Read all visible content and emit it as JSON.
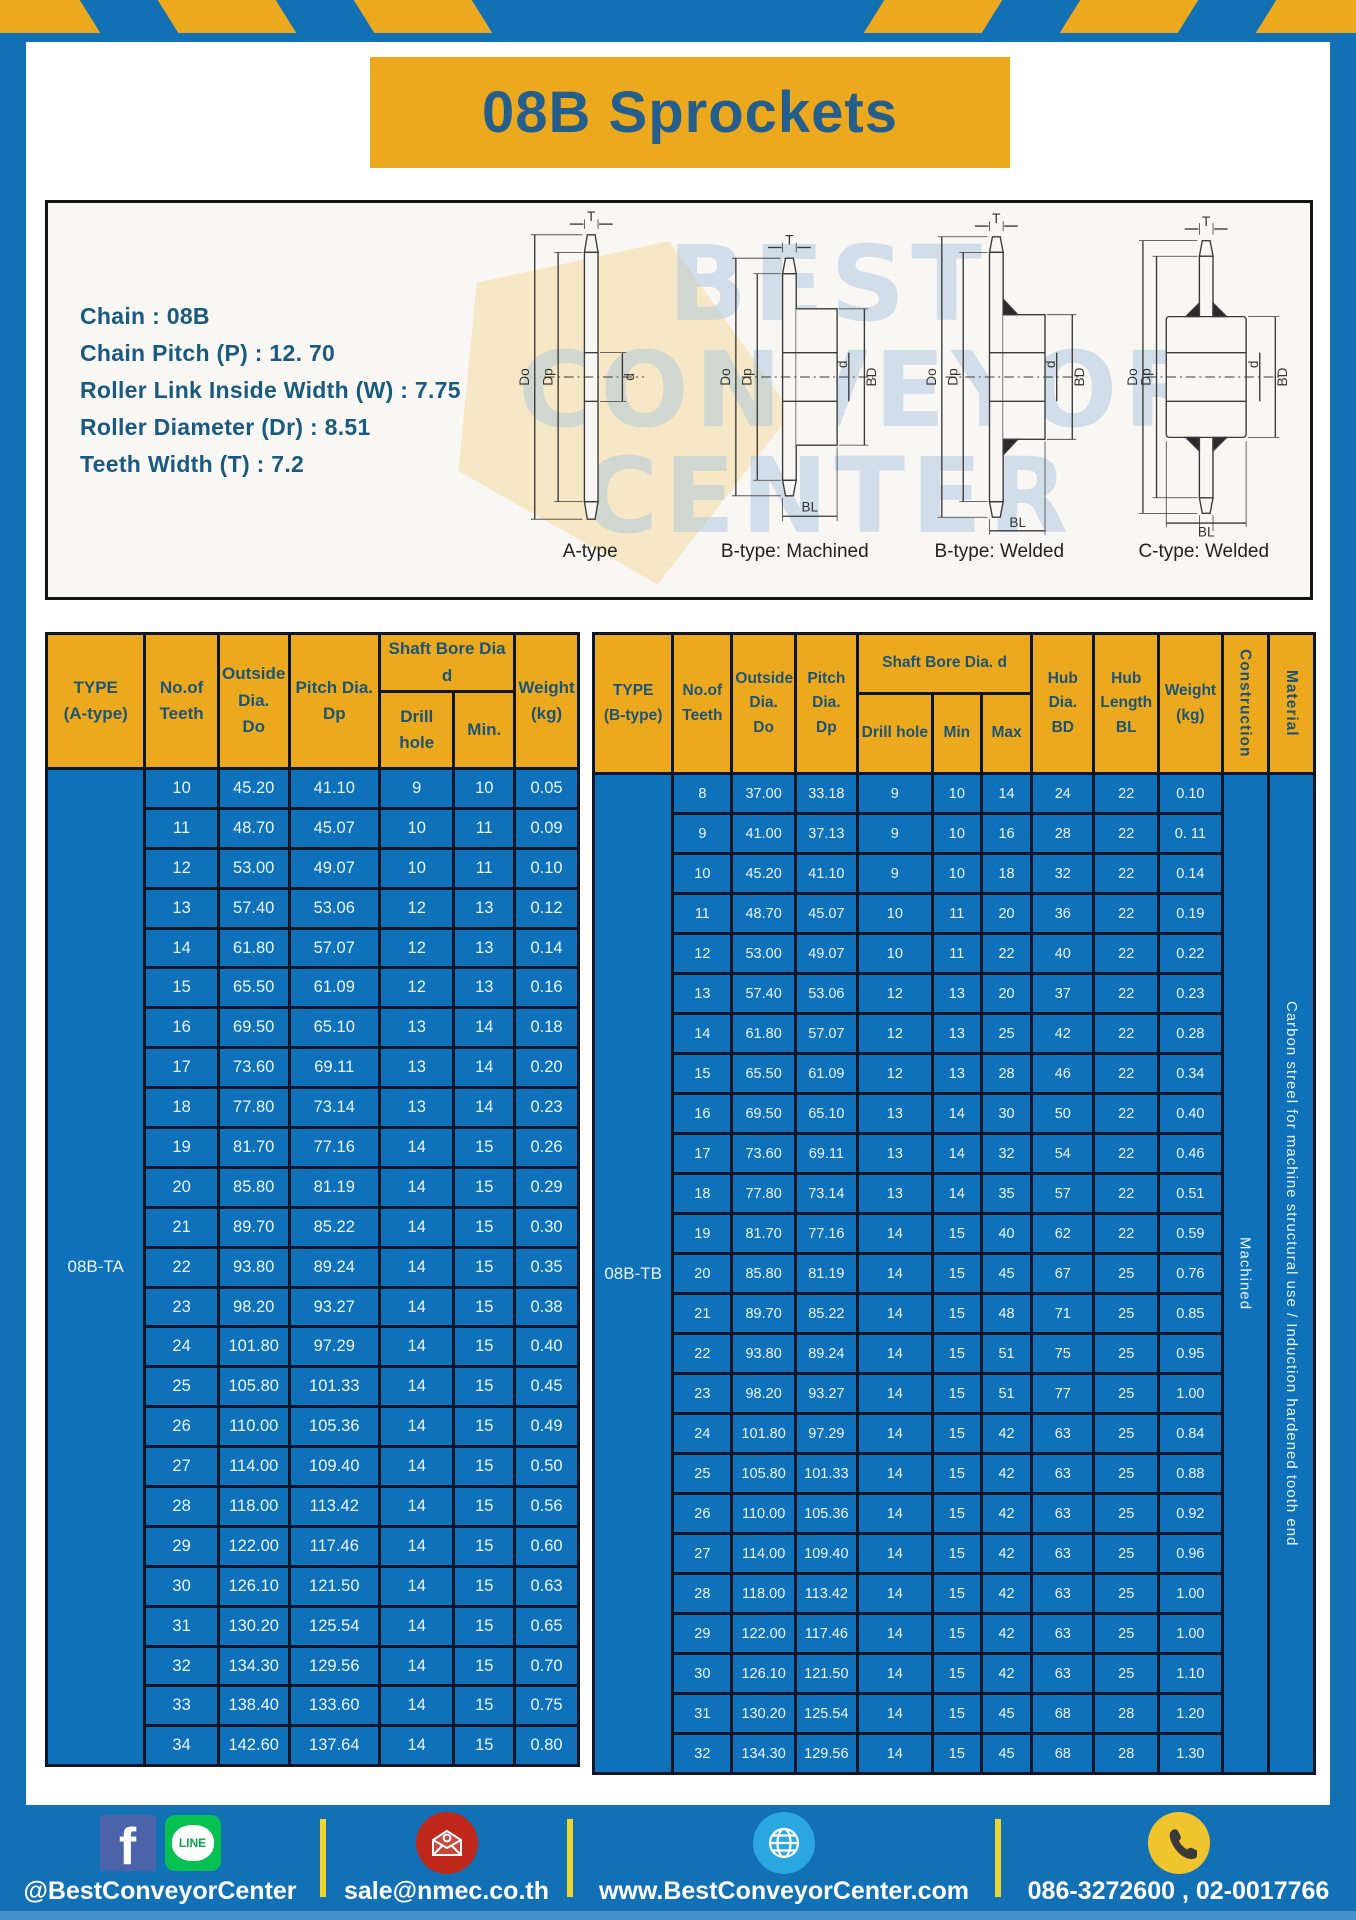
{
  "page": {
    "title": "08B Sprockets"
  },
  "specs": {
    "lines": [
      "Chain  : 08B",
      "Chain Pitch (P)  :  12. 70",
      "Roller Link Inside Width (W)  :  7.75",
      "Roller Diameter (Dr)  : 8.51",
      "Teeth Width (T)  :  7.2"
    ]
  },
  "watermark": {
    "line1": "BEST",
    "line2": "CONVEYOR",
    "line3": "CENTER"
  },
  "drawings": [
    {
      "label": "A-type",
      "dims": {
        "t": "T",
        "do": "Do",
        "dp": "Dp",
        "d": "d"
      }
    },
    {
      "label": "B-type: Machined",
      "dims": {
        "t": "T",
        "do": "Do",
        "dp": "Dp",
        "d": "d",
        "bd": "BD",
        "bl": "BL"
      }
    },
    {
      "label": "B-type: Welded",
      "dims": {
        "t": "T",
        "do": "Do",
        "dp": "Dp",
        "d": "d",
        "bd": "BD",
        "bl": "BL"
      }
    },
    {
      "label": "C-type: Welded",
      "dims": {
        "t": "T",
        "do": "Do",
        "dp": "Dp",
        "d": "d",
        "bd": "BD",
        "bl": "BL"
      }
    }
  ],
  "table_a": {
    "header": {
      "type": "TYPE\n(A-type)",
      "teeth": "No.of\nTeeth",
      "outside": "Outside\nDia.\nDo",
      "pitch": "Pitch Dia.\nDp",
      "shaft": "Shaft Bore Dia d",
      "drill": "Drill hole",
      "min": "Min.",
      "weight": "Weight\n(kg)"
    },
    "type_value": "08B-TA",
    "rows": [
      [
        "10",
        "45.20",
        "41.10",
        "9",
        "10",
        "0.05"
      ],
      [
        "11",
        "48.70",
        "45.07",
        "10",
        "11",
        "0.09"
      ],
      [
        "12",
        "53.00",
        "49.07",
        "10",
        "11",
        "0.10"
      ],
      [
        "13",
        "57.40",
        "53.06",
        "12",
        "13",
        "0.12"
      ],
      [
        "14",
        "61.80",
        "57.07",
        "12",
        "13",
        "0.14"
      ],
      [
        "15",
        "65.50",
        "61.09",
        "12",
        "13",
        "0.16"
      ],
      [
        "16",
        "69.50",
        "65.10",
        "13",
        "14",
        "0.18"
      ],
      [
        "17",
        "73.60",
        "69.11",
        "13",
        "14",
        "0.20"
      ],
      [
        "18",
        "77.80",
        "73.14",
        "13",
        "14",
        "0.23"
      ],
      [
        "19",
        "81.70",
        "77.16",
        "14",
        "15",
        "0.26"
      ],
      [
        "20",
        "85.80",
        "81.19",
        "14",
        "15",
        "0.29"
      ],
      [
        "21",
        "89.70",
        "85.22",
        "14",
        "15",
        "0.30"
      ],
      [
        "22",
        "93.80",
        "89.24",
        "14",
        "15",
        "0.35"
      ],
      [
        "23",
        "98.20",
        "93.27",
        "14",
        "15",
        "0.38"
      ],
      [
        "24",
        "101.80",
        "97.29",
        "14",
        "15",
        "0.40"
      ],
      [
        "25",
        "105.80",
        "101.33",
        "14",
        "15",
        "0.45"
      ],
      [
        "26",
        "110.00",
        "105.36",
        "14",
        "15",
        "0.49"
      ],
      [
        "27",
        "114.00",
        "109.40",
        "14",
        "15",
        "0.50"
      ],
      [
        "28",
        "118.00",
        "113.42",
        "14",
        "15",
        "0.56"
      ],
      [
        "29",
        "122.00",
        "117.46",
        "14",
        "15",
        "0.60"
      ],
      [
        "30",
        "126.10",
        "121.50",
        "14",
        "15",
        "0.63"
      ],
      [
        "31",
        "130.20",
        "125.54",
        "14",
        "15",
        "0.65"
      ],
      [
        "32",
        "134.30",
        "129.56",
        "14",
        "15",
        "0.70"
      ],
      [
        "33",
        "138.40",
        "133.60",
        "14",
        "15",
        "0.75"
      ],
      [
        "34",
        "142.60",
        "137.64",
        "14",
        "15",
        "0.80"
      ]
    ]
  },
  "table_b": {
    "header": {
      "type": "TYPE\n(B-type)",
      "teeth": "No.of\nTeeth",
      "outside": "Outside\nDia.\nDo",
      "pitch": "Pitch\nDia.\nDp",
      "shaft": "Shaft Bore Dia.  d",
      "drill": "Drill hole",
      "min": "Min",
      "max": "Max",
      "hub_dia": "Hub\nDia.\nBD",
      "hub_len": "Hub\nLength\nBL",
      "weight": "Weight\n(kg)",
      "construction": "Construction",
      "material": "Material"
    },
    "type_value": "08B-TB",
    "construction_value": "Machined",
    "material_value": "Carbon streel for machine structural use / Induction hardened tooth end",
    "rows": [
      [
        "8",
        "37.00",
        "33.18",
        "9",
        "10",
        "14",
        "24",
        "22",
        "0.10"
      ],
      [
        "9",
        "41.00",
        "37.13",
        "9",
        "10",
        "16",
        "28",
        "22",
        "0. 11"
      ],
      [
        "10",
        "45.20",
        "41.10",
        "9",
        "10",
        "18",
        "32",
        "22",
        "0.14"
      ],
      [
        "11",
        "48.70",
        "45.07",
        "10",
        "11",
        "20",
        "36",
        "22",
        "0.19"
      ],
      [
        "12",
        "53.00",
        "49.07",
        "10",
        "11",
        "22",
        "40",
        "22",
        "0.22"
      ],
      [
        "13",
        "57.40",
        "53.06",
        "12",
        "13",
        "20",
        "37",
        "22",
        "0.23"
      ],
      [
        "14",
        "61.80",
        "57.07",
        "12",
        "13",
        "25",
        "42",
        "22",
        "0.28"
      ],
      [
        "15",
        "65.50",
        "61.09",
        "12",
        "13",
        "28",
        "46",
        "22",
        "0.34"
      ],
      [
        "16",
        "69.50",
        "65.10",
        "13",
        "14",
        "30",
        "50",
        "22",
        "0.40"
      ],
      [
        "17",
        "73.60",
        "69.11",
        "13",
        "14",
        "32",
        "54",
        "22",
        "0.46"
      ],
      [
        "18",
        "77.80",
        "73.14",
        "13",
        "14",
        "35",
        "57",
        "22",
        "0.51"
      ],
      [
        "19",
        "81.70",
        "77.16",
        "14",
        "15",
        "40",
        "62",
        "22",
        "0.59"
      ],
      [
        "20",
        "85.80",
        "81.19",
        "14",
        "15",
        "45",
        "67",
        "25",
        "0.76"
      ],
      [
        "21",
        "89.70",
        "85.22",
        "14",
        "15",
        "48",
        "71",
        "25",
        "0.85"
      ],
      [
        "22",
        "93.80",
        "89.24",
        "14",
        "15",
        "51",
        "75",
        "25",
        "0.95"
      ],
      [
        "23",
        "98.20",
        "93.27",
        "14",
        "15",
        "51",
        "77",
        "25",
        "1.00"
      ],
      [
        "24",
        "101.80",
        "97.29",
        "14",
        "15",
        "42",
        "63",
        "25",
        "0.84"
      ],
      [
        "25",
        "105.80",
        "101.33",
        "14",
        "15",
        "42",
        "63",
        "25",
        "0.88"
      ],
      [
        "26",
        "110.00",
        "105.36",
        "14",
        "15",
        "42",
        "63",
        "25",
        "0.92"
      ],
      [
        "27",
        "114.00",
        "109.40",
        "14",
        "15",
        "42",
        "63",
        "25",
        "0.96"
      ],
      [
        "28",
        "118.00",
        "113.42",
        "14",
        "15",
        "42",
        "63",
        "25",
        "1.00"
      ],
      [
        "29",
        "122.00",
        "117.46",
        "14",
        "15",
        "42",
        "63",
        "25",
        "1.00"
      ],
      [
        "30",
        "126.10",
        "121.50",
        "14",
        "15",
        "42",
        "63",
        "25",
        "1.10"
      ],
      [
        "31",
        "130.20",
        "125.54",
        "14",
        "15",
        "45",
        "68",
        "28",
        "1.20"
      ],
      [
        "32",
        "134.30",
        "129.56",
        "14",
        "15",
        "45",
        "68",
        "28",
        "1.30"
      ]
    ]
  },
  "footer": {
    "social_handle": "@BestConveyorCenter",
    "line_badge": "LINE",
    "email": "sale@nmec.co.th",
    "website": "www.BestConveyorCenter.com",
    "phone": "086-3272600 , 02-0017766"
  }
}
